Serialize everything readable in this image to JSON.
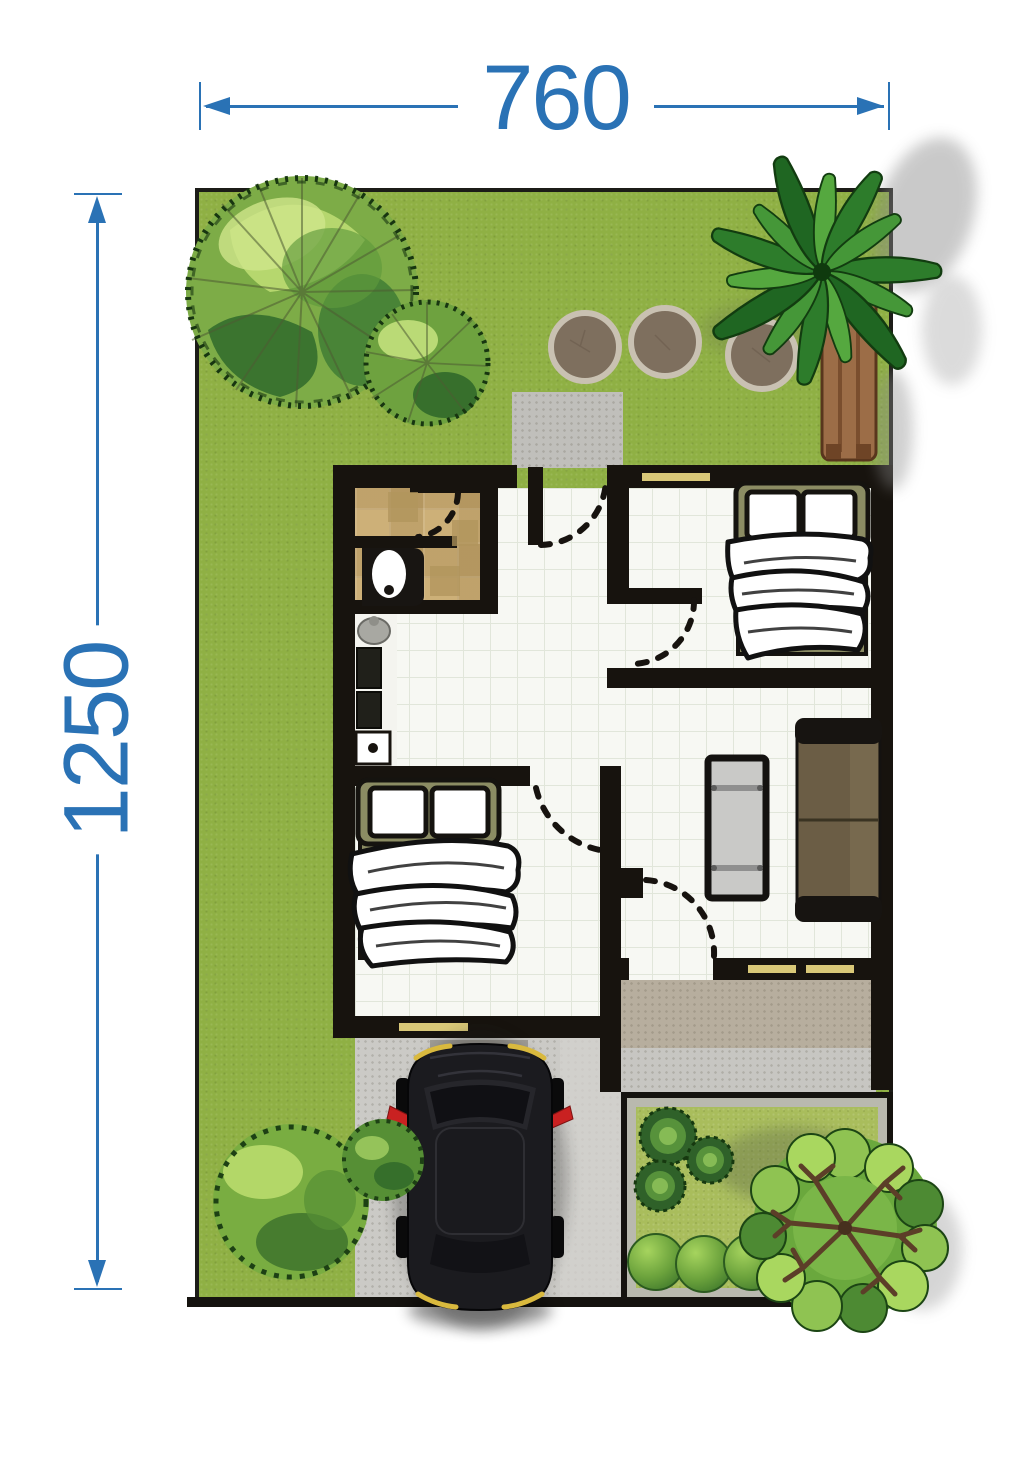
{
  "annotations": {
    "width_dimension": {
      "label": "760",
      "orientation": "horizontal",
      "position": "top"
    },
    "height_dimension": {
      "label": "1250",
      "orientation": "vertical",
      "position": "left"
    },
    "dimension_color": "#2a72b5"
  },
  "palette": {
    "grass": "#8fb044",
    "garden_grass": "#a9bd5c",
    "wall": "#17130e",
    "floor_tile": "#f7f8f3",
    "bath_tile": "#cdb078",
    "terrace": "#b7ae9e",
    "paving": "#c7c6c2",
    "driveway": "#cbcac6",
    "concrete_pad": "#c0bfbb",
    "window_frame": "#d9c878",
    "bed_frame": "#8b8c63",
    "sofa": "#6b5d45",
    "coffee_table": "#c9c9c7",
    "stepping_stone": "#7e6f5e",
    "car_body": "#1b1b1f",
    "mirror_red": "#c92121",
    "foliage_light": "#bcdc72",
    "foliage_mid": "#7dac47",
    "foliage_dark": "#2f6a2c",
    "trunk_brown": "#9c6d47"
  },
  "scene": {
    "type": "residential-lot-floor-plan",
    "features": [
      "deciduous-tree-large",
      "deciduous-tree-small",
      "palm-tree",
      "garden-bench-trunk",
      "stepping-stones",
      "back-door-pad",
      "bathroom",
      "toilet",
      "kitchen-counter",
      "sink",
      "double-bed-top-right",
      "double-bed-lower-left",
      "sofa",
      "coffee-table",
      "door-swing-arcs",
      "windows",
      "terrace",
      "paved-walk",
      "garden-bed",
      "succulent-rosettes",
      "hedge-row",
      "branch-tree",
      "shrub-large",
      "shrub-small",
      "car",
      "driveway",
      "door-mat"
    ]
  }
}
